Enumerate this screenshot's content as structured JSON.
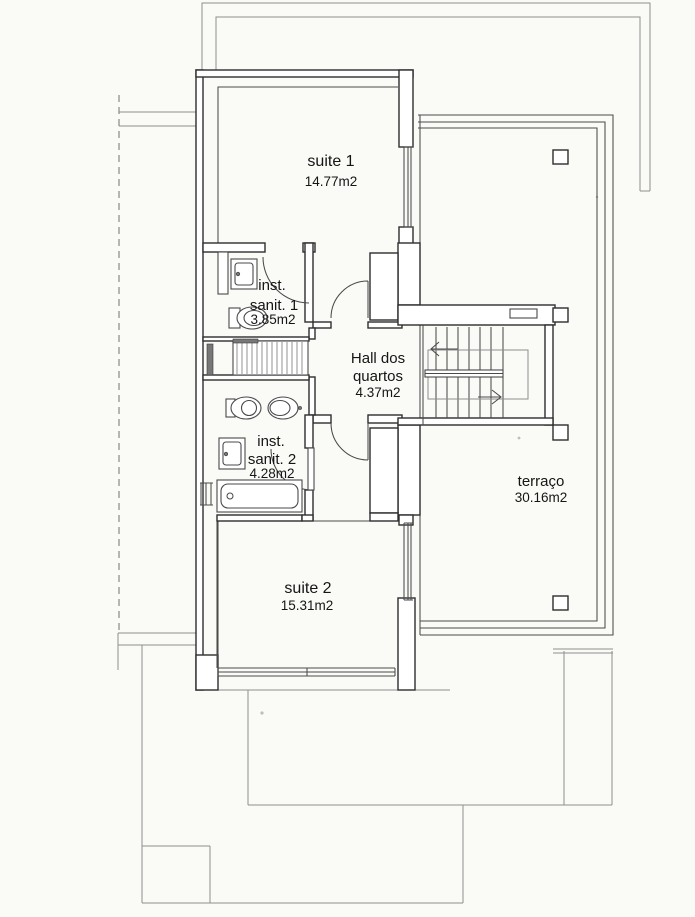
{
  "rooms": {
    "suite1": {
      "name": "suite 1",
      "area": "14.77m2"
    },
    "sanit1": {
      "line1": "inst.",
      "line2": "sanit. 1",
      "area": "3.85m2"
    },
    "hall": {
      "line1": "Hall dos",
      "line2": "quartos",
      "area": "4.37m2"
    },
    "sanit2": {
      "line1": "inst.",
      "line2": "sanit. 2",
      "area": "4.28m2"
    },
    "suite2": {
      "name": "suite 2",
      "area": "15.31m2"
    },
    "terraco": {
      "name": "terraço",
      "area": "30.16m2"
    }
  },
  "colors": {
    "paper": "#fafaf7",
    "wall": "#2e2e2e",
    "line": "#4a4a4a",
    "light": "#8f8f8f",
    "text": "#151515"
  }
}
